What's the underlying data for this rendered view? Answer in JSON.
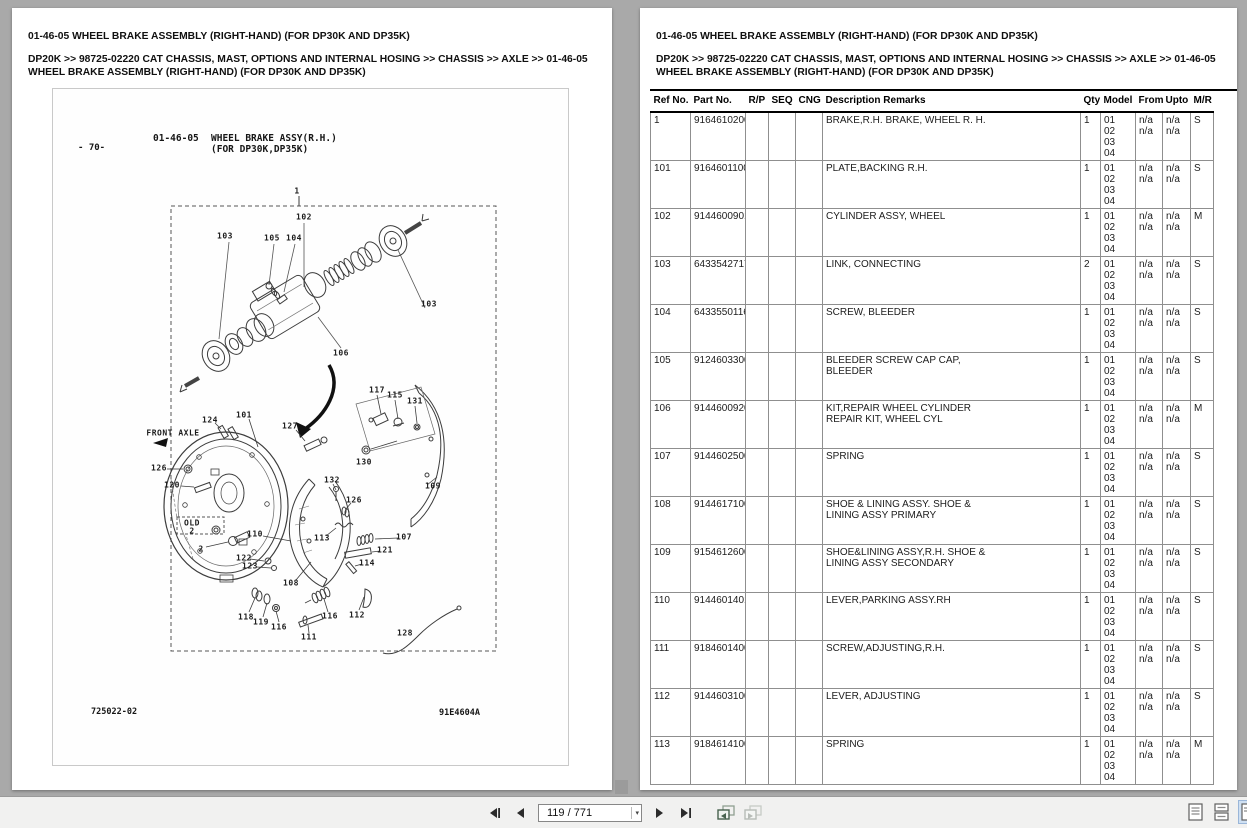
{
  "colors": {
    "background": "#a9a9a9",
    "page": "#ffffff",
    "toolbar_bg": "#f1f1f0",
    "selected_view_bg": "#cfe0f2",
    "table_rule": "#000000",
    "table_grid": "#8f8f8f"
  },
  "left_page": {
    "title": "01-46-05 WHEEL BRAKE ASSEMBLY (RIGHT-HAND) (FOR DP30K AND DP35K)",
    "breadcrumb": "DP20K >> 98725-02220 CAT CHASSIS, MAST, OPTIONS AND INTERNAL HOSING >> CHASSIS >> AXLE >> 01-46-05 WHEEL BRAKE ASSEMBLY (RIGHT-HAND) (FOR DP30K AND DP35K)",
    "diagram": {
      "page_number": "- 70-",
      "figure_code": "01-46-05",
      "figure_title_line1": "WHEEL BRAKE ASSY(R.H.)",
      "figure_title_line2": "(FOR DP30K,DP35K)",
      "footer_left": "725022-02",
      "footer_right": "91E4604A",
      "callouts": [
        {
          "t": "1",
          "x": 244,
          "y": 102
        },
        {
          "t": "102",
          "x": 251,
          "y": 128
        },
        {
          "t": "103",
          "x": 172,
          "y": 147
        },
        {
          "t": "105",
          "x": 219,
          "y": 149
        },
        {
          "t": "104",
          "x": 241,
          "y": 149
        },
        {
          "t": "103",
          "x": 376,
          "y": 215
        },
        {
          "t": "106",
          "x": 288,
          "y": 264
        },
        {
          "t": "117",
          "x": 324,
          "y": 301
        },
        {
          "t": "115",
          "x": 342,
          "y": 306
        },
        {
          "t": "131",
          "x": 362,
          "y": 312
        },
        {
          "t": "130",
          "x": 311,
          "y": 373
        },
        {
          "t": "109",
          "x": 380,
          "y": 397
        },
        {
          "t": "124",
          "x": 157,
          "y": 331
        },
        {
          "t": "101",
          "x": 191,
          "y": 326
        },
        {
          "t": "127",
          "x": 237,
          "y": 337
        },
        {
          "t": "FRONT AXLE",
          "x": 120,
          "y": 344
        },
        {
          "t": "126",
          "x": 106,
          "y": 379
        },
        {
          "t": "120",
          "x": 119,
          "y": 396
        },
        {
          "t": "132",
          "x": 279,
          "y": 391
        },
        {
          "t": "126",
          "x": 301,
          "y": 411
        },
        {
          "t": "110",
          "x": 202,
          "y": 445
        },
        {
          "t": "113",
          "x": 269,
          "y": 449
        },
        {
          "t": "107",
          "x": 351,
          "y": 448
        },
        {
          "t": "121",
          "x": 332,
          "y": 461
        },
        {
          "t": "114",
          "x": 314,
          "y": 474
        },
        {
          "t": "122",
          "x": 191,
          "y": 469
        },
        {
          "t": "123",
          "x": 197,
          "y": 477
        },
        {
          "t": "108",
          "x": 238,
          "y": 494
        },
        {
          "t": "OLD",
          "x": 139,
          "y": 434
        },
        {
          "t": "2",
          "x": 139,
          "y": 442
        },
        {
          "t": "2",
          "x": 148,
          "y": 460
        },
        {
          "t": "118",
          "x": 193,
          "y": 528
        },
        {
          "t": "119",
          "x": 208,
          "y": 533
        },
        {
          "t": "116",
          "x": 226,
          "y": 538
        },
        {
          "t": "111",
          "x": 256,
          "y": 548
        },
        {
          "t": "116",
          "x": 277,
          "y": 527
        },
        {
          "t": "112",
          "x": 304,
          "y": 526
        },
        {
          "t": "128",
          "x": 352,
          "y": 544
        }
      ]
    }
  },
  "right_page": {
    "title": "01-46-05 WHEEL BRAKE ASSEMBLY (RIGHT-HAND) (FOR DP30K AND DP35K)",
    "breadcrumb": "DP20K >> 98725-02220 CAT CHASSIS, MAST, OPTIONS AND INTERNAL HOSING >> CHASSIS >> AXLE >> 01-46-05 WHEEL BRAKE ASSEMBLY (RIGHT-HAND) (FOR DP30K AND DP35K)",
    "table": {
      "headers": [
        "Ref No.",
        "Part No.",
        "R/P",
        "SEQ",
        "CNG",
        "Description Remarks",
        "Qty",
        "Model",
        "From",
        "Upto",
        "M/R"
      ],
      "model_lines": [
        "01",
        "02",
        "03",
        "04"
      ],
      "from_lines": [
        "n/a",
        "n/a"
      ],
      "upto_lines": [
        "n/a",
        "n/a"
      ],
      "rows": [
        {
          "ref": "1",
          "part": "9164610200",
          "desc": [
            "BRAKE,R.H. BRAKE, WHEEL R. H."
          ],
          "qty": "1",
          "mr": "S"
        },
        {
          "ref": "101",
          "part": "9164601100",
          "desc": [
            "PLATE,BACKING R.H."
          ],
          "qty": "1",
          "mr": "S"
        },
        {
          "ref": "102",
          "part": "9144600901",
          "desc": [
            "CYLINDER ASSY, WHEEL"
          ],
          "qty": "1",
          "mr": "M"
        },
        {
          "ref": "103",
          "part": "6433542717",
          "desc": [
            "LINK, CONNECTING"
          ],
          "qty": "2",
          "mr": "S"
        },
        {
          "ref": "104",
          "part": "6433550116",
          "desc": [
            "SCREW, BLEEDER"
          ],
          "qty": "1",
          "mr": "S"
        },
        {
          "ref": "105",
          "part": "9124603300",
          "desc": [
            "BLEEDER SCREW CAP CAP,",
            "BLEEDER"
          ],
          "qty": "1",
          "mr": "S"
        },
        {
          "ref": "106",
          "part": "9144600920",
          "desc": [
            "KIT,REPAIR WHEEL CYLINDER",
            "REPAIR KIT, WHEEL CYL"
          ],
          "qty": "1",
          "mr": "M"
        },
        {
          "ref": "107",
          "part": "9144602500",
          "desc": [
            "SPRING"
          ],
          "qty": "1",
          "mr": "S"
        },
        {
          "ref": "108",
          "part": "9144617100",
          "desc": [
            "SHOE & LINING ASSY. SHOE &",
            "LINING ASSY PRIMARY"
          ],
          "qty": "1",
          "mr": "S"
        },
        {
          "ref": "109",
          "part": "9154612600",
          "desc": [
            "SHOE&LINING ASSY,R.H. SHOE &",
            "LINING ASSY SECONDARY"
          ],
          "qty": "1",
          "mr": "S"
        },
        {
          "ref": "110",
          "part": "9144601401",
          "desc": [
            "LEVER,PARKING ASSY.RH"
          ],
          "qty": "1",
          "mr": "S"
        },
        {
          "ref": "111",
          "part": "9184601400",
          "desc": [
            "SCREW,ADJUSTING,R.H."
          ],
          "qty": "1",
          "mr": "S"
        },
        {
          "ref": "112",
          "part": "9144603100",
          "desc": [
            "LEVER, ADJUSTING"
          ],
          "qty": "1",
          "mr": "S"
        },
        {
          "ref": "113",
          "part": "9184614100",
          "desc": [
            "SPRING"
          ],
          "qty": "1",
          "mr": "M"
        }
      ]
    }
  },
  "toolbar": {
    "page_indicator": "119 / 771",
    "icons": {
      "first_page": "first-page-icon",
      "previous_page": "previous-page-icon",
      "next_page": "next-page-icon",
      "last_page": "last-page-icon",
      "previous_view": "previous-view-icon",
      "next_view": "next-view-icon",
      "single_page_view": "single-page-view-icon",
      "continuous_view": "continuous-view-icon",
      "facing_view": "facing-view-icon"
    }
  }
}
